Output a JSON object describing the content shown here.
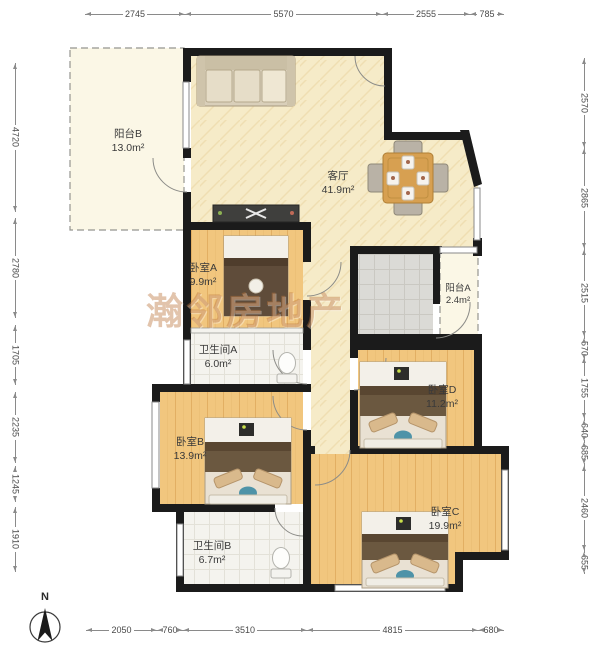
{
  "watermark": {
    "text": "瀚邻房地产"
  },
  "north": {
    "label": "N"
  },
  "rooms": [
    {
      "name": "阳台B",
      "area": "13.0m²"
    },
    {
      "name": "客厅",
      "area": "41.9m²"
    },
    {
      "name": "卧室A",
      "area": "9.9m²"
    },
    {
      "name": "阳台A",
      "area": "2.4m²"
    },
    {
      "name": "卫生间A",
      "area": "6.0m²"
    },
    {
      "name": "卧室D",
      "area": "11.2m²"
    },
    {
      "name": "卧室B",
      "area": "13.9m²"
    },
    {
      "name": "卫生间B",
      "area": "6.7m²"
    },
    {
      "name": "卧室C",
      "area": "19.9m²"
    }
  ],
  "dimensions": {
    "top": [
      "2745",
      "5570",
      "2555",
      "785"
    ],
    "bottom": [
      "2050",
      "760",
      "3510",
      "4815",
      "680"
    ],
    "left": [
      "4720",
      "2780",
      "1705",
      "2235",
      "1245",
      "1910"
    ],
    "right": [
      "2570",
      "2865",
      "2515",
      "570",
      "1755",
      "640",
      "685",
      "2460",
      "655"
    ]
  },
  "colors": {
    "wall": "#1b1b1b",
    "wood_floor": "#f1c67e",
    "living_floor": "#f6ebc8",
    "bath_tile": "#f4f3ee",
    "kitchen_tile": "#dbdad6",
    "balcony_floor": "#fbf7e6",
    "watermark": "#ba723a",
    "dimension_line": "#8a8a8a"
  }
}
